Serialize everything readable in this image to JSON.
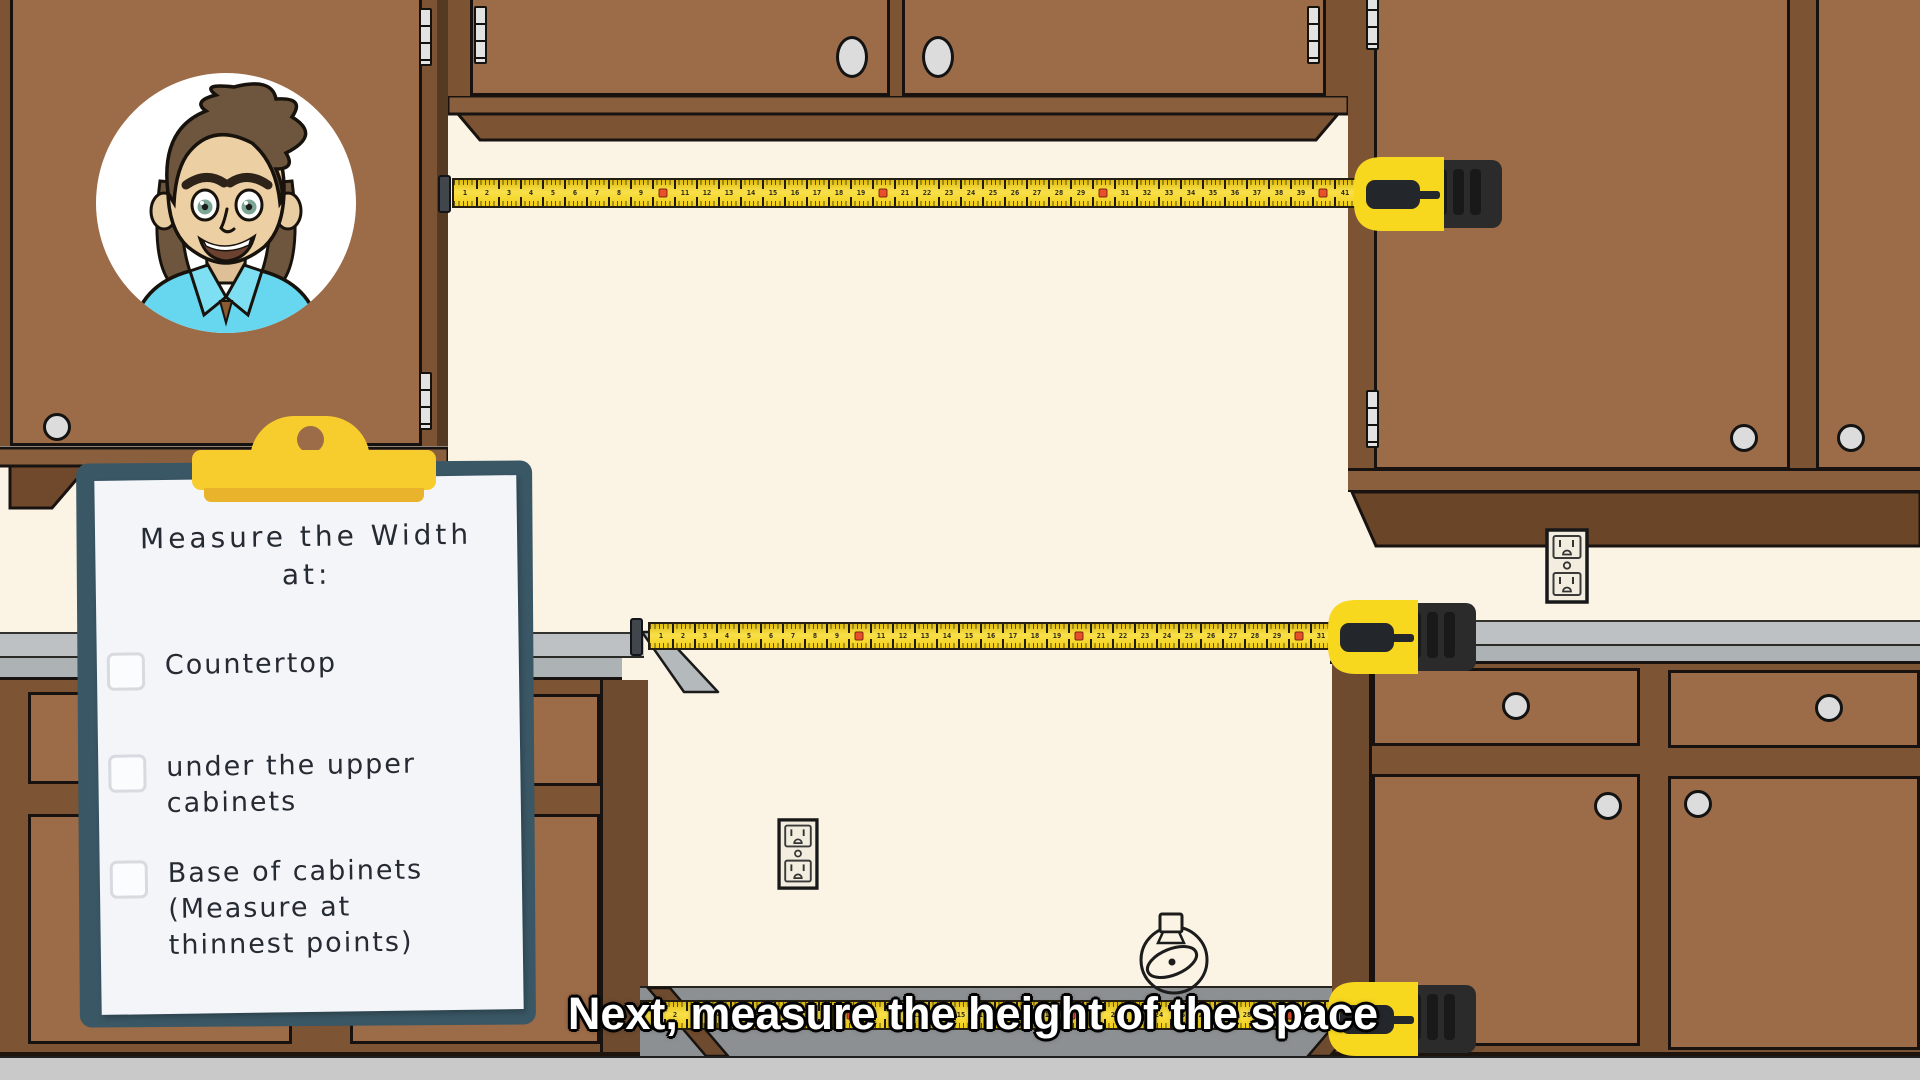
{
  "scene": {
    "description": "Cartoon kitchen scene for appliance-measuring tutorial",
    "presenter": "cartoon man avatar in circle"
  },
  "clipboard": {
    "title": "Measure the Width\nat:",
    "items": [
      {
        "label": "Countertop",
        "checked": false
      },
      {
        "label": "under the upper\ncabinets",
        "checked": false
      },
      {
        "label": "Base of cabinets\n(Measure at\nthinnest points)",
        "checked": false
      }
    ]
  },
  "caption": {
    "text": "Next, measure the height of the space"
  },
  "tape": {
    "unit_px": 22,
    "red_interval": 10,
    "blades": [
      {
        "name": "under-upper-cabinets",
        "units": 41
      },
      {
        "name": "countertop",
        "units": 31
      },
      {
        "name": "base-of-cabinets",
        "units": 31
      }
    ]
  },
  "colors": {
    "wall": "#fbf4e4",
    "cabinet_face": "#9c6b47",
    "cabinet_frame": "#7c5434",
    "cabinet_soffit": "#6b4527",
    "countertop": "#bdc1c3",
    "floor": "#c9c9c9",
    "alcove_floor": "#8d9092",
    "tape_yellow": "#f2cf17",
    "tape_red_marker": "#e8502c",
    "tape_case_black": "#2b2b2b",
    "clipboard_board": "#3a5765",
    "clipboard_paper": "#f3f5f9",
    "clip_yellow": "#f6cd2d",
    "caption_text": "#ffffff",
    "shirt_blue": "#67d7ef"
  }
}
